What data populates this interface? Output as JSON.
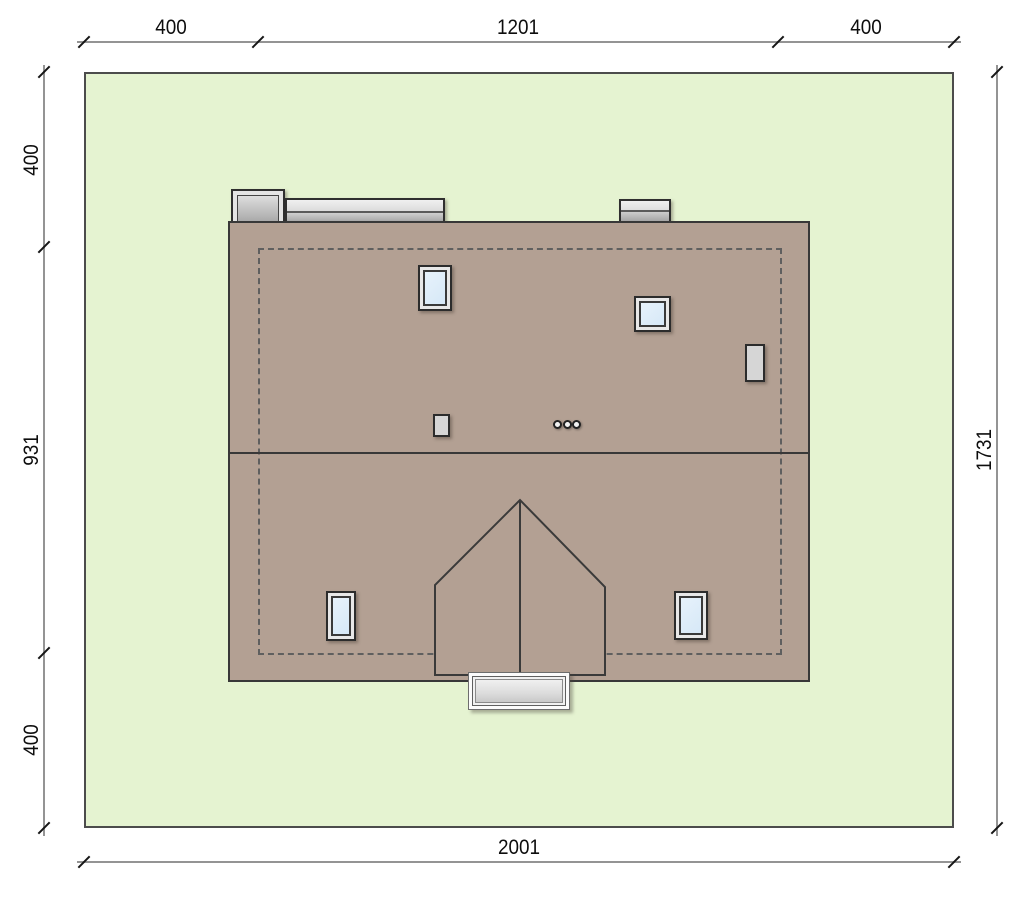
{
  "drawing": {
    "kind": "house-roof-site-plan",
    "dimensions": {
      "top": {
        "segments": [
          "400",
          "1201",
          "400"
        ]
      },
      "left": {
        "segments": [
          "400",
          "931",
          "400"
        ]
      },
      "right": {
        "segments": [
          "1731"
        ]
      },
      "bottom": {
        "segments": [
          "2001"
        ]
      }
    },
    "colors": {
      "plot_fill": "#e5f3d1",
      "plot_border": "#4c4c4c",
      "roof_fill": "#b3a093",
      "outline": "#383838",
      "dashed_building_outline": "#5f5f5f",
      "window_glass": "#d6e8f7",
      "window_frame": "#e8e8e8",
      "chimney_metal_light": "#efefef",
      "chimney_metal_dark": "#a8a8a8",
      "steps_fill": "#e0e0e0",
      "dimension_line": "#949494",
      "dimension_text": "#0d0d0d"
    }
  }
}
